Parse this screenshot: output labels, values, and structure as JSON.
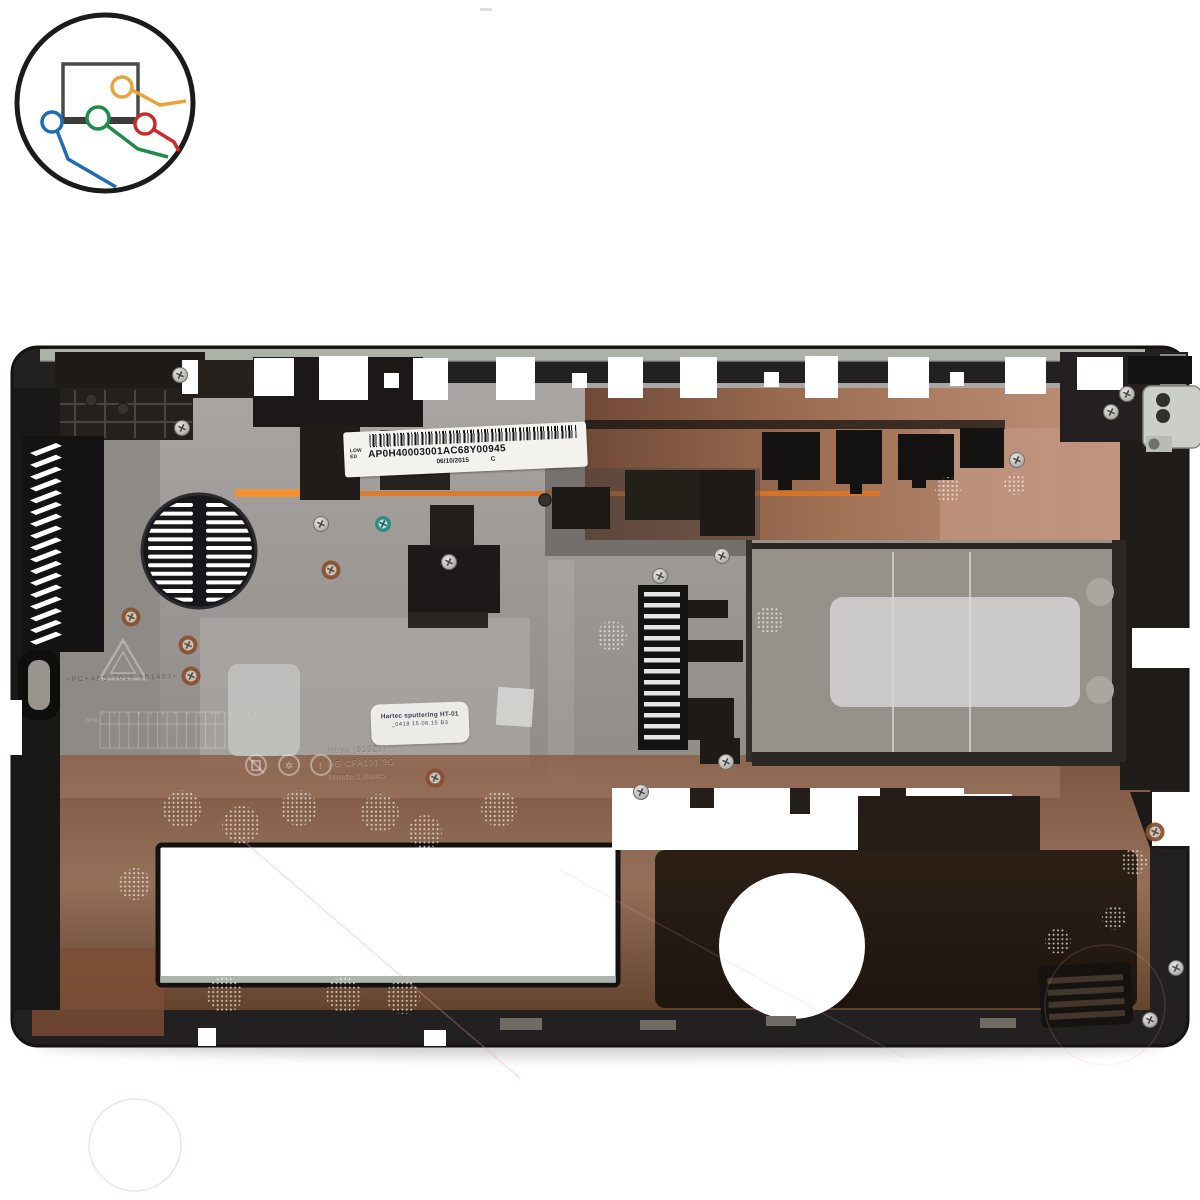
{
  "image": {
    "type": "product-photo",
    "subject": "laptop bottom base cover",
    "background_color": "#ffffff"
  },
  "logo": {
    "name": "laptop-cables-logo",
    "colors": {
      "outline": "#1b1b1b",
      "laptop_gray": "#3d3d3d",
      "orange": "#e8a33d",
      "blue": "#1f6cb5",
      "green": "#1e8a4c",
      "red": "#cc2a2a"
    }
  },
  "stickers": {
    "barcode_label": {
      "side_line1": "LOW",
      "side_line2": "ED",
      "serial": "AP0H40003001AC68Y00945",
      "date": "06/10/2015",
      "rev": "C"
    },
    "qc_sticker": {
      "line1": "Hartec sputtering HT-01",
      "line2": "_0418   15.06.15   B3"
    }
  },
  "molded_markings": {
    "material_code": ">PC+ABS-T015 1B1483<",
    "mold_text_lines": [
      "Huyu (61321)",
      "HG CFA191  9G",
      "Minde Lihans"
    ],
    "date_grid_numbers": "1 2 3 4 5 6 7 8 9 10 11 12",
    "date_grid_side": "30 11",
    "compliance_icons": [
      "crossed-bin-icon",
      "recycle-sun-icon",
      "exclamation-icon"
    ]
  },
  "part_colors": {
    "chassis_plastic": "#232021",
    "emi_shield_silver": "#a7a3a0",
    "copper_tint": "#9c6a4e",
    "copper_highlight": "#c59a7e",
    "ram_door_sticker": "#cbcac8",
    "accent_glow": "#e0761f",
    "teal_screw": "#2f8d85"
  }
}
